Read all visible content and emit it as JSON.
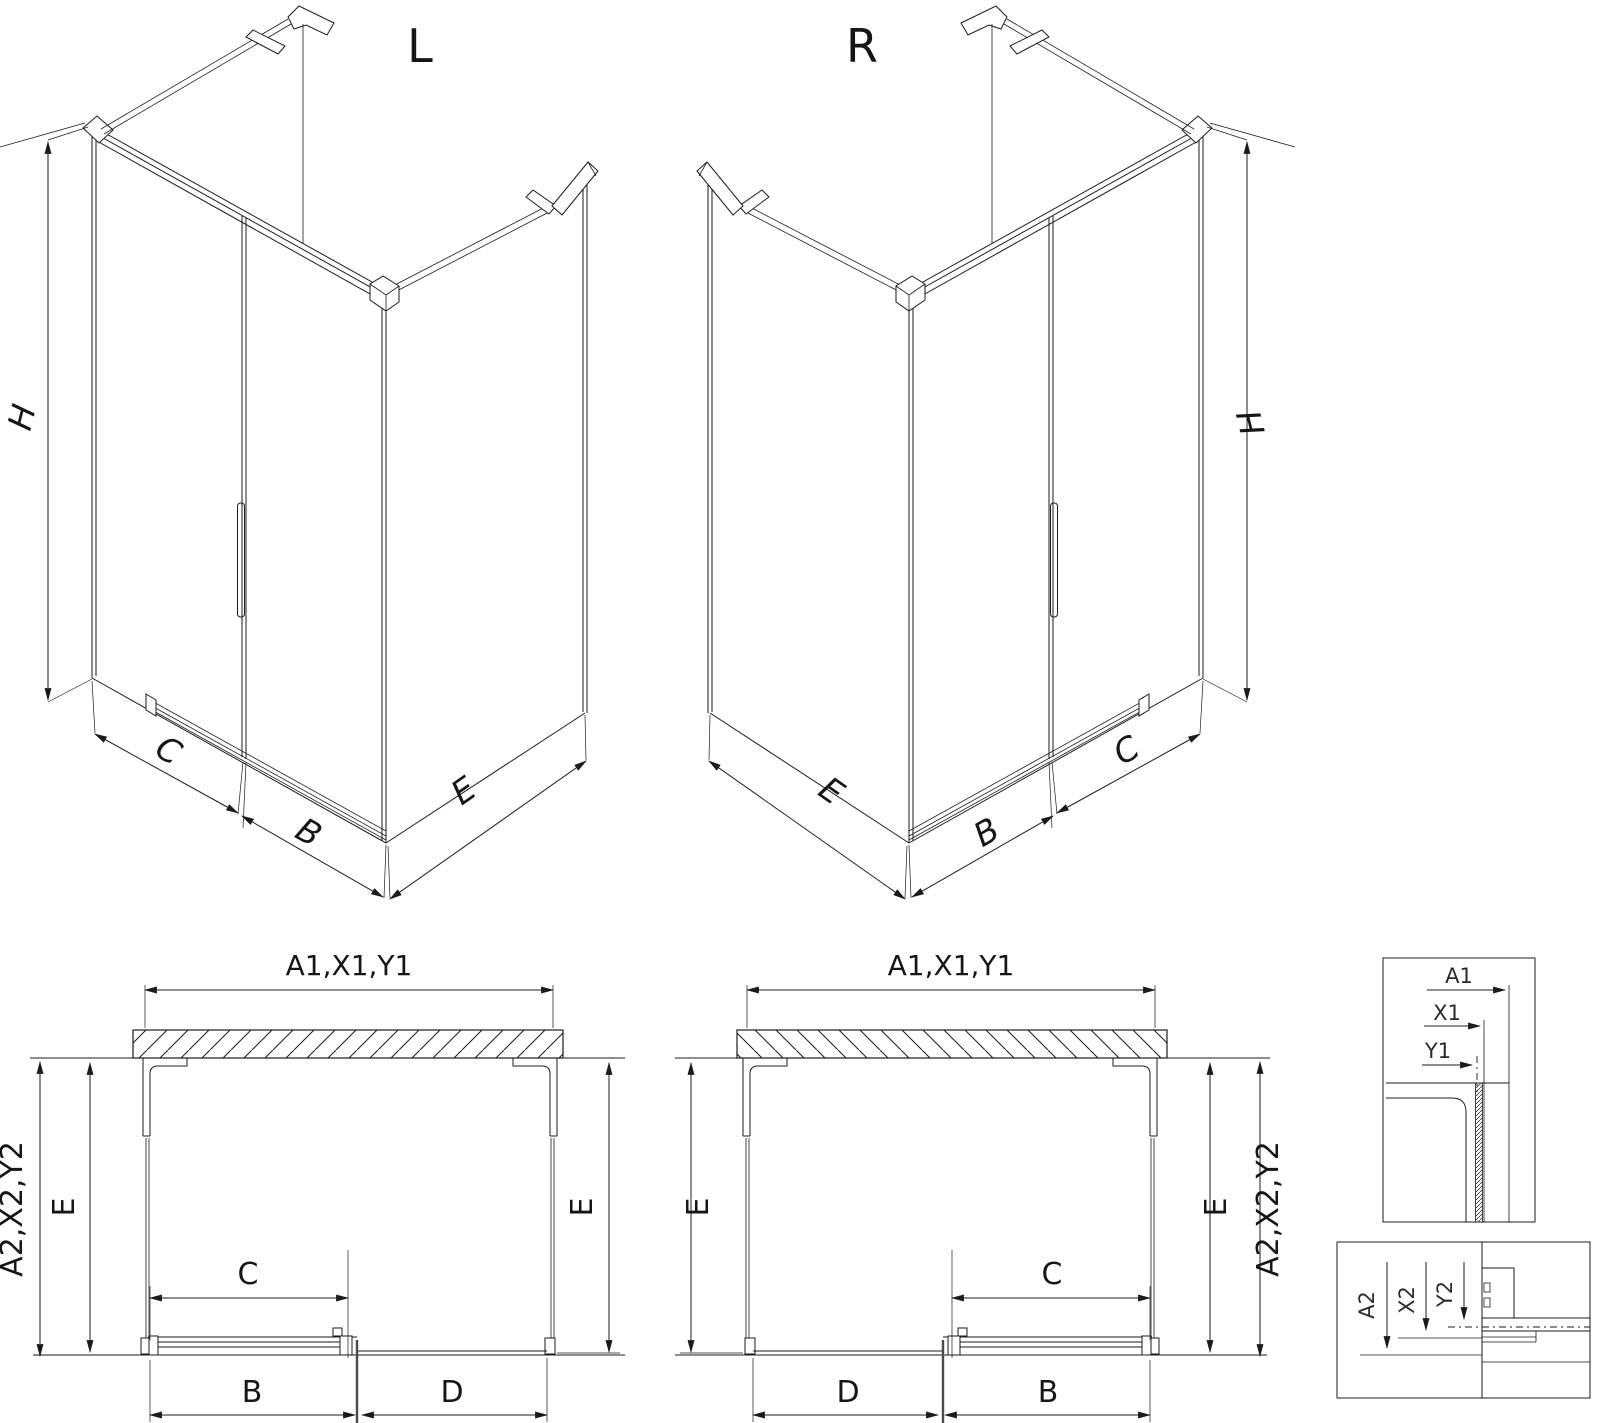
{
  "colors": {
    "line": "#1b1b1b",
    "text": "#161616",
    "background": "#ffffff",
    "divider_grey": "#4a4a4a"
  },
  "iso_l": {
    "title": "L",
    "dim_h": "H",
    "dim_c": "C",
    "dim_b": "B",
    "dim_e": "E"
  },
  "iso_r": {
    "title": "R",
    "dim_h": "H",
    "dim_c": "C",
    "dim_b": "B",
    "dim_e": "E"
  },
  "plan_l": {
    "dim_top": "A1,X1,Y1",
    "dim_outer": "A2,X2,Y2",
    "dim_e_outer": "E",
    "dim_e_inner": "E",
    "dim_c": "C",
    "dim_b": "B",
    "dim_d": "D"
  },
  "plan_r": {
    "dim_top": "A1,X1,Y1",
    "dim_outer": "A2,X2,Y2",
    "dim_e_outer": "E",
    "dim_e_inner": "E",
    "dim_c": "C",
    "dim_b": "B",
    "dim_d": "D"
  },
  "detail_top": {
    "dim_a1": "A1",
    "dim_x1": "X1",
    "dim_y1": "Y1"
  },
  "detail_bottom": {
    "dim_a2": "A2",
    "dim_x2": "X2",
    "dim_y2": "Y2"
  }
}
